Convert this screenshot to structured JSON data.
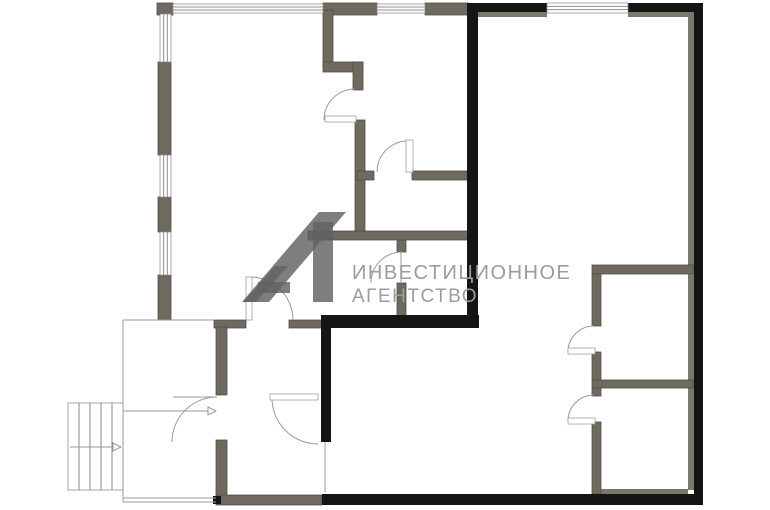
{
  "watermark": {
    "line1": "ИНВЕСТИЦИОННОЕ",
    "line2": "АГЕНТСТВО",
    "logo_glyph": "A1-diagonal-logo"
  },
  "colors": {
    "background": "#ffffff",
    "gray_wall": "#6f6a60",
    "gray_wall_stroke": "#4d4a42",
    "lining": "#7b776d",
    "black_wall": "#151515",
    "thin_line": "#9a9a9a",
    "window_stroke": "#8f8f8f",
    "door_arc": "#9b9b9b",
    "stair_stroke": "#8a8a8a",
    "watermark_text": "#9c9c9c",
    "logo_fill": "#616161"
  },
  "plan": {
    "canvas_w": 770,
    "canvas_h": 510,
    "gray_walls": [
      [
        157,
        3,
        16,
        12
      ],
      [
        158,
        62,
        13,
        93
      ],
      [
        158,
        197,
        13,
        35
      ],
      [
        158,
        275,
        13,
        45
      ],
      [
        323,
        3,
        54,
        12
      ],
      [
        425,
        3,
        44,
        12
      ],
      [
        323,
        10,
        10,
        57
      ],
      [
        323,
        62,
        40,
        10
      ],
      [
        353,
        62,
        10,
        28
      ],
      [
        355,
        120,
        10,
        118
      ],
      [
        308,
        231,
        162,
        9
      ],
      [
        397,
        240,
        9,
        12
      ],
      [
        397,
        283,
        9,
        40
      ],
      [
        357,
        171,
        17,
        9
      ],
      [
        412,
        171,
        56,
        9
      ],
      [
        214,
        320,
        32,
        8
      ],
      [
        289,
        320,
        33,
        8
      ],
      [
        216,
        327,
        11,
        68
      ],
      [
        216,
        440,
        11,
        62
      ],
      [
        216,
        495,
        106,
        10
      ],
      [
        592,
        265,
        101,
        9
      ],
      [
        592,
        274,
        9,
        52
      ],
      [
        592,
        352,
        9,
        28
      ],
      [
        592,
        380,
        101,
        8
      ],
      [
        592,
        388,
        9,
        8
      ],
      [
        592,
        422,
        9,
        72
      ]
    ],
    "linings": [
      [
        477,
        12,
        70,
        5
      ],
      [
        628,
        12,
        60,
        5
      ],
      [
        688,
        12,
        6,
        478
      ],
      [
        597,
        489,
        91,
        6
      ]
    ],
    "black_walls": [
      [
        468,
        3,
        79,
        9
      ],
      [
        628,
        3,
        75,
        9
      ],
      [
        694,
        3,
        9,
        502
      ],
      [
        322,
        494,
        381,
        11
      ],
      [
        467,
        3,
        11,
        325
      ],
      [
        322,
        315,
        157,
        13
      ],
      [
        321,
        315,
        10,
        127
      ],
      [
        213,
        496,
        8,
        8
      ]
    ],
    "windows": [
      {
        "x": 160,
        "y": 14,
        "w": 11,
        "h": 48,
        "o": "v"
      },
      {
        "x": 160,
        "y": 155,
        "w": 11,
        "h": 42,
        "o": "v"
      },
      {
        "x": 160,
        "y": 232,
        "w": 11,
        "h": 43,
        "o": "v"
      },
      {
        "x": 173,
        "y": 4,
        "w": 150,
        "h": 9,
        "o": "h"
      },
      {
        "x": 377,
        "y": 4,
        "w": 48,
        "h": 9,
        "o": "h"
      },
      {
        "x": 547,
        "y": 3,
        "w": 81,
        "h": 10,
        "o": "h"
      }
    ],
    "thin_lines": [
      [
        123,
        320,
        214,
        320
      ],
      [
        123,
        320,
        123,
        502
      ],
      [
        123,
        498,
        216,
        498
      ],
      [
        123,
        502,
        216,
        502
      ],
      [
        110,
        429,
        123,
        412
      ],
      [
        325,
        442,
        325,
        492
      ]
    ],
    "arrows": [
      {
        "x1": 70,
        "y1": 447,
        "x2": 113,
        "y2": 447
      },
      {
        "x1": 123,
        "y1": 411,
        "x2": 208,
        "y2": 411
      }
    ],
    "stairs": {
      "x": 68,
      "y": 403,
      "w": 55,
      "h": 87,
      "treads_x": [
        79,
        90,
        101,
        112
      ]
    },
    "doors": [
      {
        "cx": 355,
        "cy": 120,
        "r": 31,
        "a1": 90,
        "a2": 180,
        "bar": [
          325,
          116,
          31,
          6
        ]
      },
      {
        "cx": 408,
        "cy": 172,
        "r": 31,
        "a1": 90,
        "a2": 180,
        "bar": [
          406,
          140,
          7,
          32
        ]
      },
      {
        "cx": 402,
        "cy": 283,
        "r": 31,
        "a1": 90,
        "a2": 180,
        "line": [
          401,
          252,
          401,
          283
        ]
      },
      {
        "cx": 217,
        "cy": 442,
        "r": 45,
        "a1": 90,
        "a2": 180,
        "line": [
          173,
          397,
          217,
          397
        ]
      },
      {
        "cx": 318,
        "cy": 398,
        "r": 46,
        "a1": 180,
        "a2": 270,
        "bar": [
          270,
          394,
          48,
          6
        ]
      },
      {
        "cx": 250,
        "cy": 320,
        "r": 43,
        "a1": 0,
        "a2": 90,
        "bar": [
          246,
          277,
          6,
          43
        ]
      },
      {
        "cx": 594,
        "cy": 352,
        "r": 26,
        "a1": 90,
        "a2": 180,
        "bar": [
          568,
          348,
          27,
          6
        ]
      },
      {
        "cx": 594,
        "cy": 421,
        "r": 26,
        "a1": 90,
        "a2": 180,
        "bar": [
          568,
          418,
          27,
          6
        ]
      }
    ],
    "logo_polys": [
      [
        [
          242,
          302
        ],
        [
          269,
          302
        ],
        [
          346,
          212
        ],
        [
          319,
          212
        ]
      ],
      [
        [
          243,
          302
        ],
        [
          256,
          302
        ],
        [
          288,
          266
        ],
        [
          275,
          266
        ]
      ],
      [
        [
          258,
          282
        ],
        [
          290,
          282
        ],
        [
          290,
          293
        ],
        [
          258,
          293
        ]
      ],
      [
        [
          313,
          222
        ],
        [
          333,
          222
        ],
        [
          333,
          302
        ],
        [
          313,
          302
        ]
      ]
    ],
    "logo_opacity": 0.82
  }
}
